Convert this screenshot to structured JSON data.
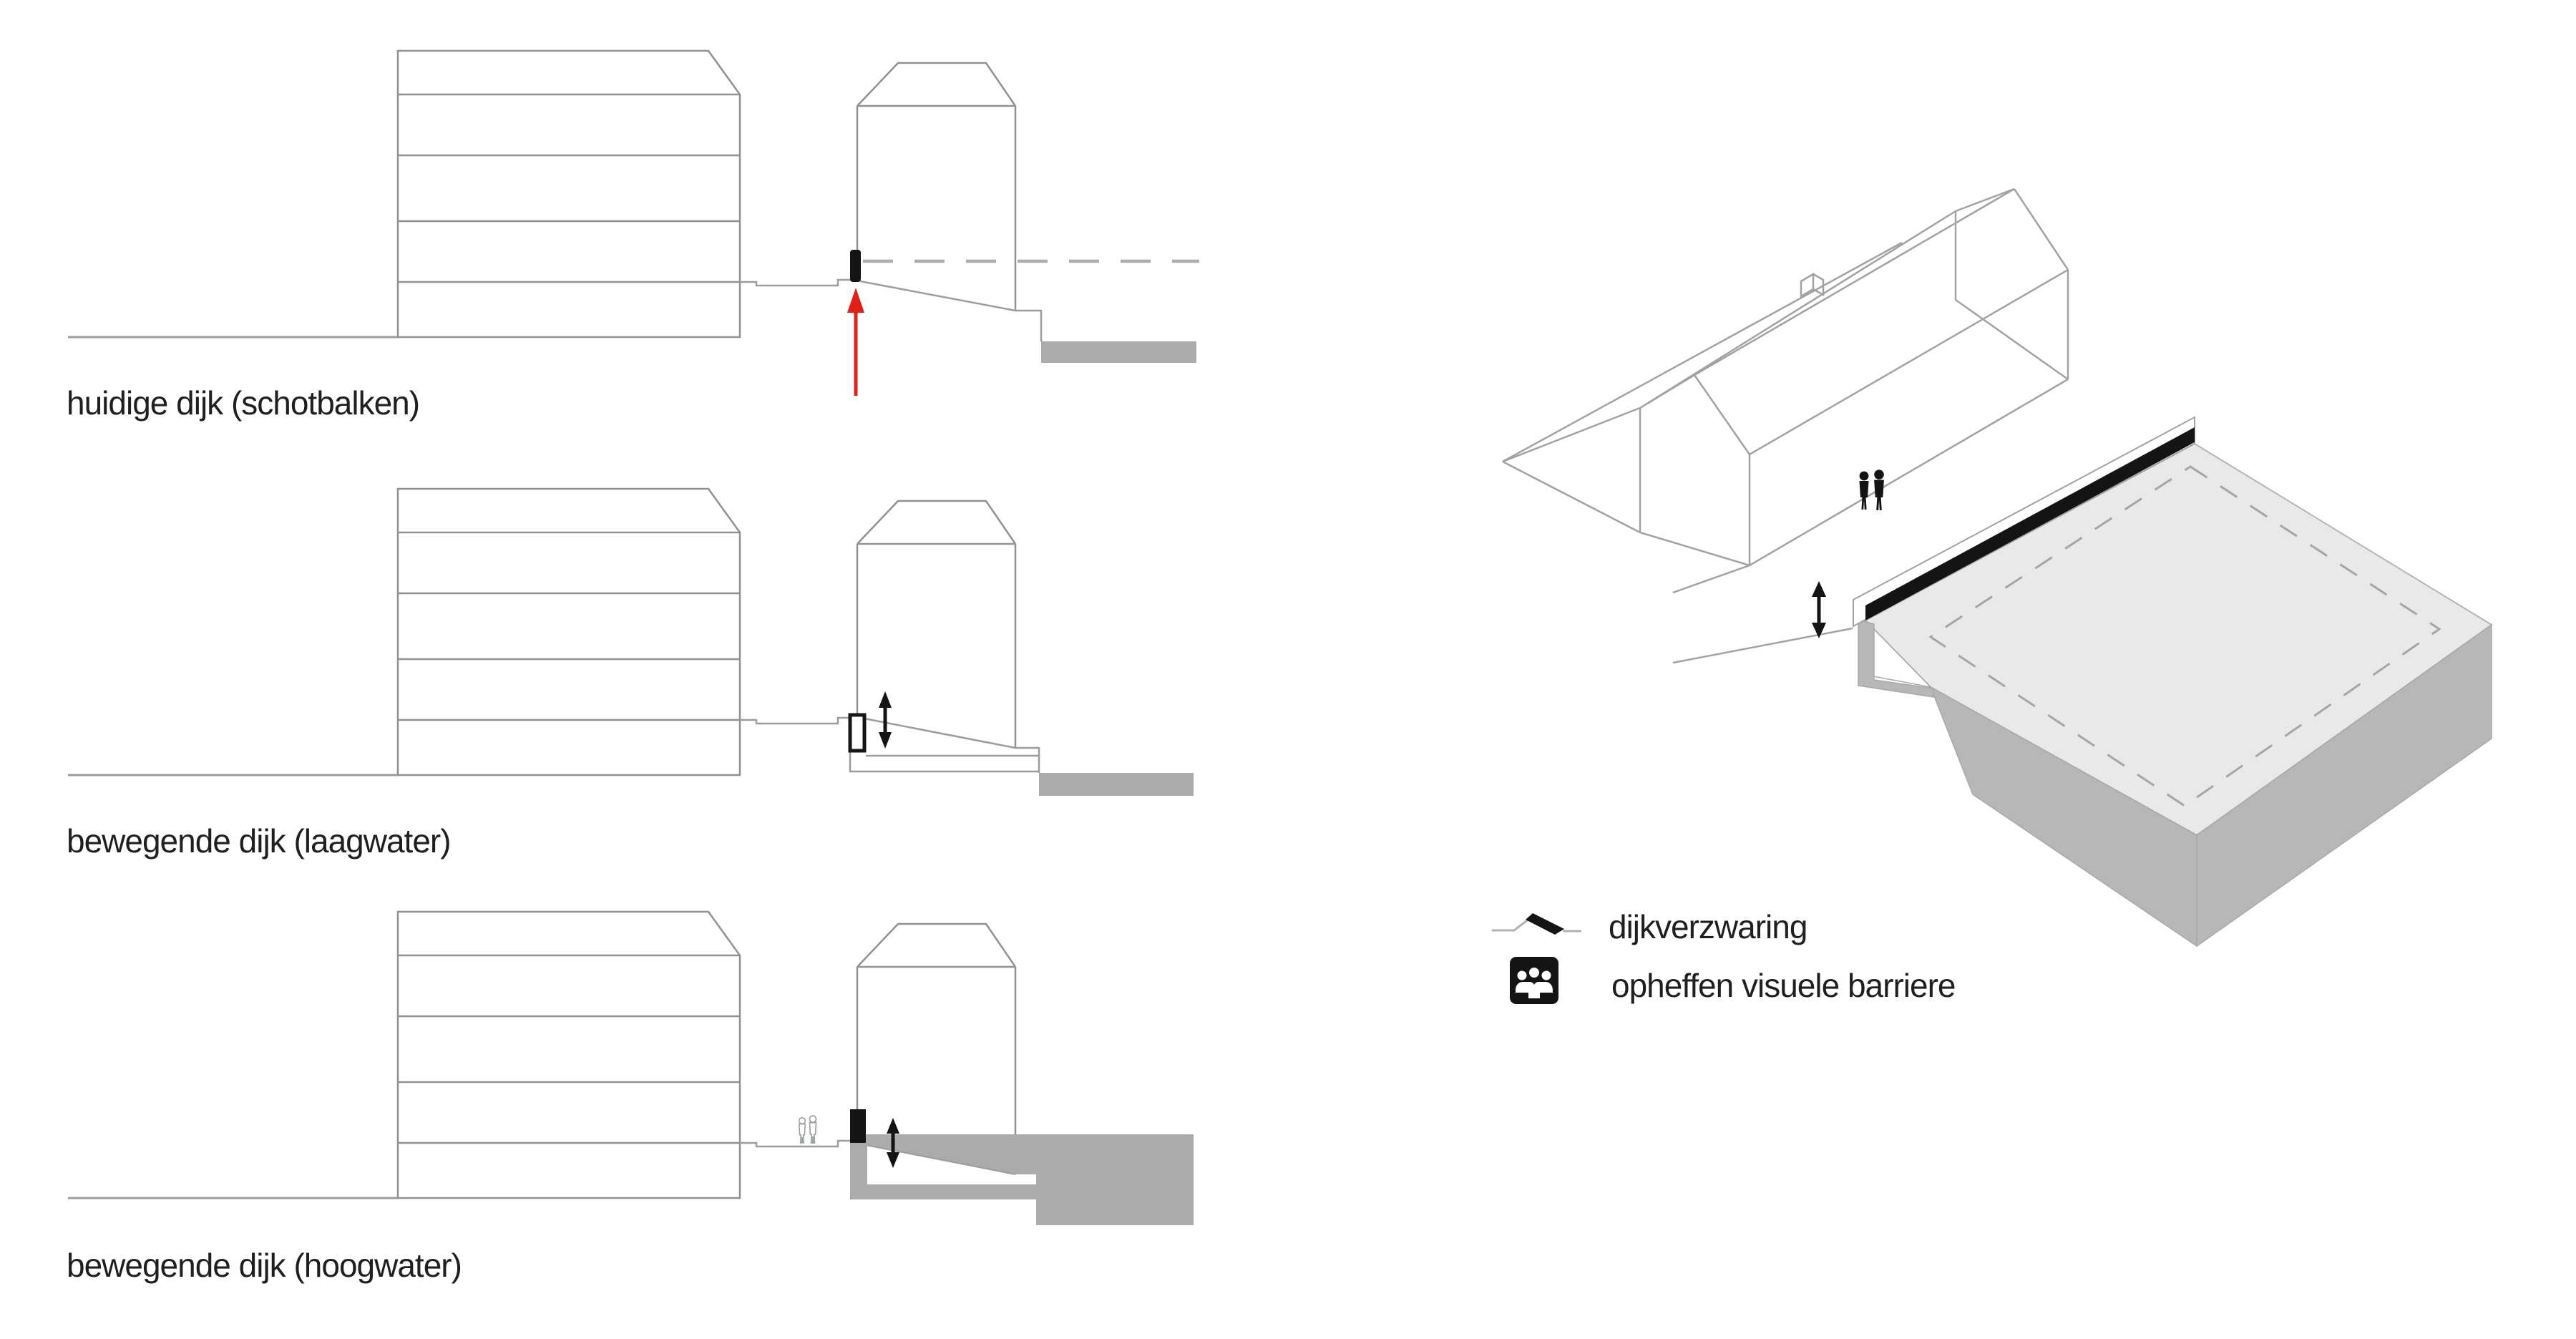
{
  "page": {
    "background": "#ffffff"
  },
  "sections": [
    {
      "label": "huidige dijk (schotbalken)"
    },
    {
      "label": "bewegende dijk (laagwater)"
    },
    {
      "label": "bewegende dijk (hoogwater)"
    }
  ],
  "legend": {
    "items": [
      {
        "icon": "dike-reinforcement-icon",
        "label": "dijkverzwaring"
      },
      {
        "icon": "remove-visual-barrier-icon",
        "label": "opheffen visuele barriere"
      }
    ]
  },
  "colors": {
    "outline_gray": "#8f9193",
    "light_gray_line": "#adadad",
    "water_gray": "#ababab",
    "platform_top_gray": "#e9e9e9",
    "platform_side_gray": "#b7b7b7",
    "barrier_black": "#141414",
    "arrow_red": "#df2118",
    "text": "#1f1f1f"
  }
}
